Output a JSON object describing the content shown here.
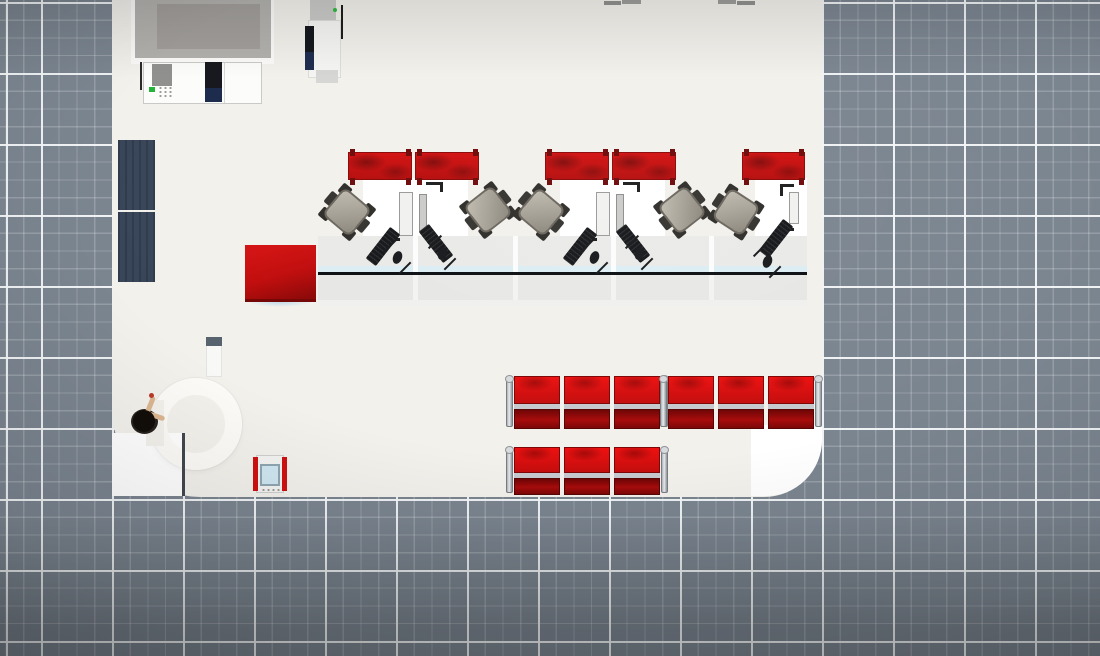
{
  "colors": {
    "grid_base": "#7b8590",
    "grid_major_line": "#f0f3f5",
    "grid_minor_line": "rgba(255,255,255,0.20)",
    "floor": "#f3f1ec",
    "floor_bright": "#ffffff",
    "brand_red": "#c60d0d",
    "dark_red": "#7e0707",
    "seat_silver": "#c6c9cd",
    "chair_gray": "#a49f94",
    "counter_gray": "#e9e9e7",
    "counter_edge_black": "#0b0e12",
    "counter_glass_blue": "#dcedf4",
    "mat_navy": "#394659",
    "device_gray": "#b2b1ae",
    "screen_gray": "#a19e9b",
    "ink_black": "#17191c",
    "navy_cartridge": "#1c2a4b",
    "led_green": "#25b43a",
    "kiosk_screen_blue": "#cfe7f1",
    "skin": "#dcb691",
    "hair_black": "#120d09"
  },
  "grid": {
    "major_spacing_px": 71,
    "minor_spacing_px": 17.75,
    "major_offset_px": [
      41,
      2
    ]
  },
  "room": {
    "left": 112,
    "right": 822,
    "bottom": 497,
    "corner_radius_bottom_left": 88,
    "corner_radius_bottom_right": 58
  },
  "scene": {
    "objects": [
      {
        "name": "bank-floor",
        "type": "box",
        "x": 112,
        "y": -60,
        "w": 710,
        "h": 557,
        "bg": "#f3f1ec",
        "radius": "0 0 58px 88px",
        "inter": false
      },
      {
        "name": "entrance-floor-bright",
        "type": "box",
        "x": 112,
        "y": 433,
        "w": 71,
        "h": 63,
        "bg": "#ffffff",
        "inter": false
      },
      {
        "name": "corner-floor-bright",
        "type": "box",
        "x": 751,
        "y": 425,
        "w": 71,
        "h": 71,
        "bg": "#ffffff",
        "radius": "0 0 56px 0",
        "inter": false
      },
      {
        "name": "revolving-door-ring",
        "type": "ring",
        "x": 150,
        "y": 378,
        "size": 92,
        "inter": true
      },
      {
        "name": "ring-opening-patch",
        "type": "box",
        "x": 146,
        "y": 400,
        "w": 18,
        "h": 46,
        "bg": "#f3f1ec",
        "inter": false
      },
      {
        "name": "entrance-door-frame",
        "type": "box",
        "x": 182,
        "y": 433,
        "w": 3,
        "h": 63,
        "bg": "#41474e",
        "inter": false
      },
      {
        "name": "entry-mat-upper",
        "type": "box",
        "cls": "mat",
        "x": 118,
        "y": 140,
        "w": 37,
        "h": 70,
        "inter": false
      },
      {
        "name": "entry-mat-lower",
        "type": "box",
        "cls": "mat",
        "x": 118,
        "y": 212,
        "w": 37,
        "h": 70,
        "inter": false
      },
      {
        "name": "wall-display",
        "type": "group",
        "x": 131,
        "y": 0,
        "w": 143,
        "h": 64,
        "inter": true,
        "children": [
          {
            "name": "display-base",
            "x": 0,
            "y": 0,
            "w": 143,
            "h": 64,
            "bg": "#fbfaf8"
          },
          {
            "name": "display-frame",
            "x": 4,
            "y": 0,
            "w": 136,
            "h": 58,
            "bg": "#b2b1ae"
          },
          {
            "name": "display-screen",
            "x": 26,
            "y": 4,
            "w": 103,
            "h": 45,
            "bg": "#a19e9b"
          }
        ]
      },
      {
        "name": "printer-copier",
        "type": "group",
        "x": 140,
        "y": 60,
        "w": 124,
        "h": 44,
        "inter": true,
        "children": [
          {
            "name": "printer-cable",
            "x": 0,
            "y": 2,
            "w": 2,
            "h": 28,
            "bg": "#2b2b2b"
          },
          {
            "name": "printer-body",
            "x": 3,
            "y": 2,
            "w": 119,
            "h": 42,
            "bg": "#fcfcfb",
            "border": "1px solid #c9c9c7"
          },
          {
            "name": "printer-side-panel",
            "x": 12,
            "y": 4,
            "w": 20,
            "h": 22,
            "bg": "#90908e"
          },
          {
            "name": "printer-led",
            "x": 9,
            "y": 27,
            "w": 6,
            "h": 5,
            "bg": "#25b43a"
          },
          {
            "name": "printer-keypad",
            "cls": "keypad",
            "x": 18,
            "y": 26,
            "w": 16,
            "h": 12
          },
          {
            "name": "printer-cartridge",
            "x": 65,
            "y": 2,
            "w": 17,
            "h": 28,
            "bg": "#16181d"
          },
          {
            "name": "printer-cartridge-navy",
            "x": 65,
            "y": 28,
            "w": 17,
            "h": 14,
            "bg": "#1c2a4b"
          },
          {
            "name": "printer-seam",
            "x": 84,
            "y": 3,
            "w": 1,
            "h": 40,
            "bg": "#d8d8d6"
          }
        ]
      },
      {
        "name": "atm-kiosk",
        "type": "group",
        "x": 300,
        "y": 0,
        "w": 45,
        "h": 85,
        "inter": true,
        "children": [
          {
            "name": "atm-top",
            "x": 10,
            "y": 0,
            "w": 26,
            "h": 24,
            "bg": "#c9c9c7"
          },
          {
            "name": "atm-body",
            "x": 8,
            "y": 20,
            "w": 33,
            "h": 58,
            "bg": "#f5f5f3",
            "border": "1px solid #dcdcda"
          },
          {
            "name": "atm-screen-dark",
            "x": 5,
            "y": 26,
            "w": 9,
            "h": 30,
            "bg": "#14171c"
          },
          {
            "name": "atm-screen-navy",
            "x": 5,
            "y": 52,
            "w": 9,
            "h": 18,
            "bg": "#1d2c4e"
          },
          {
            "name": "atm-led",
            "x": 33,
            "y": 8,
            "w": 4,
            "h": 4,
            "bg": "#2db83d",
            "radius": "50%"
          },
          {
            "name": "atm-pole",
            "x": 41,
            "y": 5,
            "w": 2,
            "h": 34,
            "bg": "#1c1c1c"
          },
          {
            "name": "atm-tray",
            "x": 16,
            "y": 70,
            "w": 22,
            "h": 13,
            "bg": "#d6d6d4"
          }
        ]
      },
      {
        "name": "background-chair-top",
        "type": "box",
        "x": 604,
        "y": 1,
        "w": 17,
        "h": 4,
        "bg": "#8f8f8d",
        "inter": false
      },
      {
        "name": "background-chair-top",
        "type": "box",
        "x": 622,
        "y": 0,
        "w": 19,
        "h": 4,
        "bg": "#9c9c9a",
        "inter": false
      },
      {
        "name": "background-chair-top",
        "type": "box",
        "x": 718,
        "y": 0,
        "w": 18,
        "h": 4,
        "bg": "#9c9c9a",
        "inter": false
      },
      {
        "name": "background-chair-top",
        "type": "box",
        "x": 737,
        "y": 1,
        "w": 18,
        "h": 4,
        "bg": "#8f8f8d",
        "inter": false
      },
      {
        "name": "teller-counter",
        "type": "group",
        "x": 318,
        "y": 236,
        "w": 489,
        "h": 70,
        "inter": true,
        "children": [
          {
            "name": "counter-top",
            "x": 0,
            "y": 0,
            "w": 489,
            "h": 30,
            "bg": "#eaeae8"
          },
          {
            "name": "counter-glass",
            "x": 0,
            "y": 30,
            "w": 489,
            "h": 6,
            "bg": "#dcedf4"
          },
          {
            "name": "counter-edge",
            "x": 0,
            "y": 36,
            "w": 489,
            "h": 3,
            "bg": "#0b0e12"
          },
          {
            "name": "counter-front",
            "x": 0,
            "y": 39,
            "w": 489,
            "h": 25,
            "bg": "#e7e7e5"
          },
          {
            "name": "counter-base",
            "x": 0,
            "y": 64,
            "w": 489,
            "h": 6,
            "bg": "#f0f0ee"
          },
          {
            "name": "counter-gap",
            "x": 95,
            "y": 0,
            "w": 5,
            "h": 36,
            "bg": "rgba(255,255,255,0.85)"
          },
          {
            "name": "counter-gap",
            "x": 95,
            "y": 39,
            "w": 5,
            "h": 25,
            "bg": "rgba(255,255,255,0.5)"
          },
          {
            "name": "counter-gap",
            "x": 195,
            "y": 0,
            "w": 5,
            "h": 36,
            "bg": "rgba(255,255,255,0.85)"
          },
          {
            "name": "counter-gap",
            "x": 195,
            "y": 39,
            "w": 5,
            "h": 25,
            "bg": "rgba(255,255,255,0.5)"
          },
          {
            "name": "counter-gap",
            "x": 293,
            "y": 0,
            "w": 5,
            "h": 36,
            "bg": "rgba(255,255,255,0.85)"
          },
          {
            "name": "counter-gap",
            "x": 293,
            "y": 39,
            "w": 5,
            "h": 25,
            "bg": "rgba(255,255,255,0.5)"
          },
          {
            "name": "counter-gap",
            "x": 391,
            "y": 0,
            "w": 5,
            "h": 36,
            "bg": "rgba(255,255,255,0.85)"
          },
          {
            "name": "counter-gap",
            "x": 391,
            "y": 39,
            "w": 5,
            "h": 25,
            "bg": "rgba(255,255,255,0.5)"
          }
        ]
      },
      {
        "name": "table-shadow",
        "type": "box",
        "x": 248,
        "y": 297,
        "w": 64,
        "h": 10,
        "bg": "radial-gradient(closest-side, rgba(150,200,230,0.55), rgba(150,200,230,0))",
        "inter": false
      },
      {
        "name": "red-cube-table",
        "type": "box",
        "cls": "red-table",
        "x": 245,
        "y": 245,
        "w": 71,
        "h": 57,
        "inter": true
      },
      {
        "name": "teller-desk",
        "type": "box",
        "x": 363,
        "y": 178,
        "w": 105,
        "h": 58,
        "bg": "#ffffff",
        "inter": false
      },
      {
        "name": "teller-desk",
        "type": "box",
        "x": 560,
        "y": 178,
        "w": 105,
        "h": 58,
        "bg": "#ffffff",
        "inter": false
      },
      {
        "name": "teller-desk",
        "type": "box",
        "x": 755,
        "y": 178,
        "w": 52,
        "h": 58,
        "bg": "#ffffff",
        "inter": false
      },
      {
        "name": "divider-panel",
        "type": "red-panel",
        "x": 348,
        "y": 152,
        "w": 64,
        "h": 28,
        "inter": true
      },
      {
        "name": "divider-panel",
        "type": "red-panel",
        "x": 415,
        "y": 152,
        "w": 64,
        "h": 28,
        "inter": true
      },
      {
        "name": "divider-panel",
        "type": "red-panel",
        "x": 545,
        "y": 152,
        "w": 64,
        "h": 28,
        "inter": true
      },
      {
        "name": "divider-panel",
        "type": "red-panel",
        "x": 612,
        "y": 152,
        "w": 64,
        "h": 28,
        "inter": true
      },
      {
        "name": "divider-panel",
        "type": "red-panel",
        "x": 742,
        "y": 152,
        "w": 63,
        "h": 28,
        "inter": true
      },
      {
        "name": "office-chair",
        "type": "office-chair",
        "x": 327,
        "y": 192,
        "rot": 40,
        "inter": true
      },
      {
        "name": "office-chair",
        "type": "office-chair",
        "x": 468,
        "y": 190,
        "rot": -38,
        "inter": true
      },
      {
        "name": "office-chair",
        "type": "office-chair",
        "x": 521,
        "y": 192,
        "rot": 40,
        "inter": true
      },
      {
        "name": "office-chair",
        "type": "office-chair",
        "x": 662,
        "y": 190,
        "rot": -38,
        "inter": true
      },
      {
        "name": "office-chair",
        "type": "office-chair",
        "x": 716,
        "y": 192,
        "rot": 33,
        "inter": true
      },
      {
        "name": "teller-monitors",
        "type": "group",
        "x": 396,
        "y": 184,
        "w": 50,
        "h": 58,
        "inter": true,
        "children": [
          {
            "name": "monitor",
            "x": 3,
            "y": 8,
            "w": 14,
            "h": 44,
            "bg": "#f1f1ef",
            "border": "1px solid #9a9a98"
          },
          {
            "name": "monitor-side",
            "x": 23,
            "y": 10,
            "w": 8,
            "h": 38,
            "bg": "#cbcbc9",
            "border": "1px solid #8e8e8c"
          },
          {
            "name": "desk-mark",
            "x": 30,
            "y": -2,
            "w": 16,
            "h": 3,
            "bg": "#1d1d1d"
          },
          {
            "name": "desk-mark",
            "x": 44,
            "y": -2,
            "w": 3,
            "h": 10,
            "bg": "#1d1d1d"
          },
          {
            "name": "desk-mark",
            "x": -8,
            "y": 54,
            "w": 12,
            "h": 3,
            "bg": "#1d1d1d"
          }
        ]
      },
      {
        "name": "teller-monitors",
        "type": "group",
        "x": 593,
        "y": 184,
        "w": 50,
        "h": 58,
        "inter": true,
        "children": [
          {
            "name": "monitor",
            "x": 3,
            "y": 8,
            "w": 14,
            "h": 44,
            "bg": "#f1f1ef",
            "border": "1px solid #9a9a98"
          },
          {
            "name": "monitor-side",
            "x": 23,
            "y": 10,
            "w": 8,
            "h": 38,
            "bg": "#cbcbc9",
            "border": "1px solid #8e8e8c"
          },
          {
            "name": "desk-mark",
            "x": 30,
            "y": -2,
            "w": 16,
            "h": 3,
            "bg": "#1d1d1d"
          },
          {
            "name": "desk-mark",
            "x": 44,
            "y": -2,
            "w": 3,
            "h": 10,
            "bg": "#1d1d1d"
          },
          {
            "name": "desk-mark",
            "x": -8,
            "y": 54,
            "w": 12,
            "h": 3,
            "bg": "#1d1d1d"
          }
        ]
      },
      {
        "name": "teller-monitor-single",
        "type": "group",
        "x": 778,
        "y": 182,
        "w": 24,
        "h": 50,
        "inter": true,
        "children": [
          {
            "name": "desk-mark",
            "x": 2,
            "y": 2,
            "w": 14,
            "h": 3,
            "bg": "#1d1d1d"
          },
          {
            "name": "desk-mark",
            "x": 2,
            "y": 2,
            "w": 3,
            "h": 12,
            "bg": "#1d1d1d"
          },
          {
            "name": "desk-mark",
            "x": 2,
            "y": 46,
            "w": 14,
            "h": 3,
            "bg": "#1d1d1d"
          },
          {
            "name": "monitor",
            "x": 11,
            "y": 10,
            "w": 10,
            "h": 32,
            "bg": "#f1f1ef",
            "border": "1px solid #9a9a98"
          }
        ]
      },
      {
        "name": "keyboard",
        "type": "keyboard",
        "x": 363,
        "y": 240,
        "rot": -52,
        "inter": true
      },
      {
        "name": "keyboard",
        "type": "keyboard",
        "x": 416,
        "y": 237,
        "rot": 52,
        "inter": true
      },
      {
        "name": "keyboard",
        "type": "keyboard",
        "x": 560,
        "y": 240,
        "rot": -52,
        "inter": true
      },
      {
        "name": "keyboard",
        "type": "keyboard",
        "x": 613,
        "y": 237,
        "rot": 52,
        "inter": true
      },
      {
        "name": "keyboard",
        "type": "keyboard",
        "x": 756,
        "y": 232,
        "rot": -52,
        "inter": true
      },
      {
        "name": "mouse",
        "type": "mouse",
        "x": 398,
        "y": 258,
        "inter": true
      },
      {
        "name": "mouse",
        "type": "mouse",
        "x": 443,
        "y": 254,
        "inter": true
      },
      {
        "name": "mouse",
        "type": "mouse",
        "x": 595,
        "y": 258,
        "inter": true
      },
      {
        "name": "mouse",
        "type": "mouse",
        "x": 640,
        "y": 254,
        "inter": true
      },
      {
        "name": "mouse",
        "type": "mouse",
        "x": 768,
        "y": 262,
        "inter": true
      },
      {
        "name": "waiting-bench",
        "type": "seat-row",
        "x": 514,
        "y": 376,
        "n": 3,
        "backH": 28,
        "seatH": 20,
        "inter": true
      },
      {
        "name": "waiting-bench",
        "type": "seat-row",
        "x": 668,
        "y": 376,
        "n": 3,
        "backH": 28,
        "seatH": 20,
        "inter": true
      },
      {
        "name": "waiting-bench",
        "type": "seat-row",
        "x": 514,
        "y": 447,
        "n": 3,
        "backH": 26,
        "seatH": 17,
        "inter": true
      },
      {
        "name": "ticket-kiosk",
        "type": "group",
        "x": 253,
        "y": 455,
        "w": 34,
        "h": 38,
        "inter": true,
        "children": [
          {
            "name": "kiosk-body",
            "x": 3,
            "y": 0,
            "w": 28,
            "h": 38,
            "bg": "#f3f3f1",
            "border": "1px solid #cfcfcd"
          },
          {
            "name": "kiosk-red-rail",
            "x": 0,
            "y": 2,
            "w": 5,
            "h": 34,
            "bg": "#cf1111"
          },
          {
            "name": "kiosk-red-rail",
            "x": 29,
            "y": 2,
            "w": 5,
            "h": 34,
            "bg": "#cf1111"
          },
          {
            "name": "kiosk-screen",
            "x": 7,
            "y": 9,
            "w": 20,
            "h": 22,
            "bg": "#cfe7f1",
            "border": "2px solid #8fa6b2"
          },
          {
            "name": "kiosk-vent",
            "cls": "keypad",
            "x": 8,
            "y": 33,
            "w": 19,
            "h": 3
          }
        ]
      },
      {
        "name": "queue-stanchion",
        "type": "group",
        "x": 206,
        "y": 337,
        "w": 16,
        "h": 40,
        "inter": true,
        "children": [
          {
            "name": "stanchion-body",
            "x": 0,
            "y": 0,
            "w": 16,
            "h": 40,
            "bg": "#f8f8f6",
            "border": "1px solid #e3e3e1"
          },
          {
            "name": "stanchion-top",
            "x": 0,
            "y": 0,
            "w": 16,
            "h": 9,
            "bg": "#57636f"
          }
        ]
      },
      {
        "name": "customer-person",
        "type": "person",
        "x": 131,
        "y": 404,
        "inter": true
      }
    ]
  }
}
